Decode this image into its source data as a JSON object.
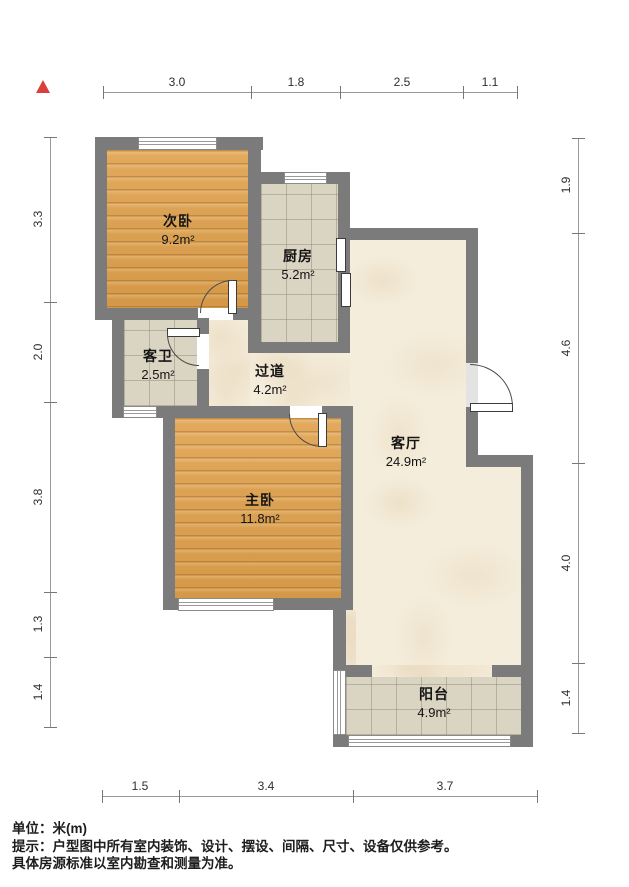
{
  "rooms": [
    {
      "id": "secondary-bedroom",
      "name": "次卧",
      "area": "9.2m²"
    },
    {
      "id": "kitchen",
      "name": "厨房",
      "area": "5.2m²"
    },
    {
      "id": "guest-bathroom",
      "name": "客卫",
      "area": "2.5m²"
    },
    {
      "id": "hallway",
      "name": "过道",
      "area": "4.2m²"
    },
    {
      "id": "living-room",
      "name": "客厅",
      "area": "24.9m²"
    },
    {
      "id": "master-bedroom",
      "name": "主卧",
      "area": "11.8m²"
    },
    {
      "id": "balcony",
      "name": "阳台",
      "area": "4.9m²"
    }
  ],
  "dimensions": {
    "top": [
      "3.0",
      "1.8",
      "2.5",
      "1.1"
    ],
    "left": [
      "3.3",
      "2.0",
      "3.8",
      "1.3",
      "1.4"
    ],
    "right": [
      "1.9",
      "4.6",
      "4.0",
      "1.4"
    ],
    "bottom": [
      "1.5",
      "3.4",
      "3.7"
    ]
  },
  "notes": {
    "unit": "单位：米(m)",
    "hint1": "提示：户型图中所有室内装饰、设计、摆设、间隔、尺寸、设备仅供参考。",
    "hint2": "具体房源标准以室内勘查和测量为准。"
  },
  "colors": {
    "wall": "#7b7b7c",
    "wood_floor": "#dfa04b",
    "tile_floor": "#d9d5c2",
    "marble_floor": "#f4eddb",
    "north_arrow": "#d8403c",
    "dimension_line": "#999999",
    "text": "#1d1d1d"
  }
}
